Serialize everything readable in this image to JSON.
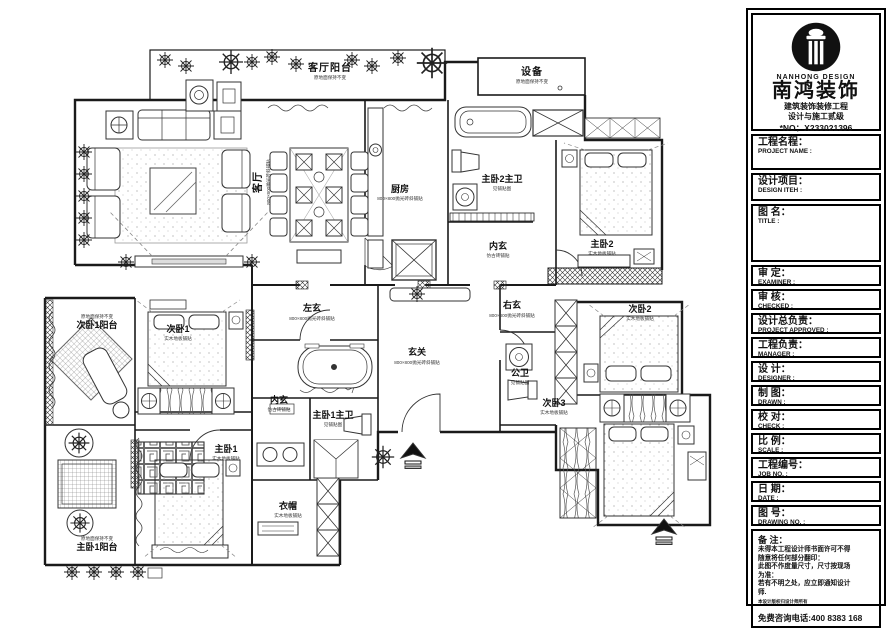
{
  "titleblock": {
    "brand": {
      "brand_en": "NANHONG DESIGN",
      "brand_cn": "南鸿装饰",
      "cert_line1": "建筑装饰装修工程",
      "cert_line2": "设计与施工贰级",
      "cert_no": "*NO：X233021396"
    },
    "fields": [
      {
        "cn": "工程名程：",
        "en": "PROJECT NAME :"
      },
      {
        "cn": "设计项目：",
        "en": "DESIGN ITEH :"
      },
      {
        "cn": "图 名：",
        "en": "TITLE :"
      },
      {
        "cn": "审  定：",
        "en": "EXAMINER :"
      },
      {
        "cn": "审  核：",
        "en": "CHECKED :"
      },
      {
        "cn": "设计总负责：",
        "en": "PROJECT APPROVED :"
      },
      {
        "cn": "工程负责：",
        "en": "MANAGER :"
      },
      {
        "cn": "设  计：",
        "en": "DESIGNER :"
      },
      {
        "cn": "制  图：",
        "en": "DRAWN :"
      },
      {
        "cn": "校  对：",
        "en": "CHECK :"
      },
      {
        "cn": "比  例：",
        "en": "SCALE :"
      },
      {
        "cn": "工程编号：",
        "en": "JOB NO. :"
      },
      {
        "cn": "日  期：",
        "en": "DATE :"
      },
      {
        "cn": "图  号：",
        "en": "DRAWING NO. :"
      }
    ],
    "remarks": {
      "label": "备 注：",
      "lines": [
        "未得本工程设计师书面许可不得",
        "随意将任何部分翻印：",
        "此图不作度量尺寸，尺寸按现场",
        "为准：",
        "若有不明之处，应立即通知设计",
        "师."
      ],
      "tiny": "本设计版权归设计师所有",
      "hotline": "免费咨询电话:400 8383 168"
    }
  },
  "plan": {
    "rooms": [
      {
        "name": "客厅阳台",
        "note": "原地面保持不变"
      },
      {
        "name": "设备",
        "note": "原地面保持不变"
      },
      {
        "name": "客厅",
        "note": "800×800抛光砖斜铺贴"
      },
      {
        "name": "厨房",
        "note": "800×800抛光砖斜铺贴"
      },
      {
        "name": "主卧2主卫",
        "note": "见铺贴图"
      },
      {
        "name": "内玄",
        "note": "仿古砖铺贴"
      },
      {
        "name": "主卧2",
        "note": "实木地板铺贴"
      },
      {
        "name": "左玄",
        "note": "800×800抛光砖斜铺贴"
      },
      {
        "name": "右玄",
        "note": "800×800抛光砖斜铺贴"
      },
      {
        "name": "玄关",
        "note": "800×800抛光砖斜铺贴"
      },
      {
        "name": "公卫",
        "note": "见铺贴图"
      },
      {
        "name": "次卧2",
        "note": "实木地板铺贴"
      },
      {
        "name": "次卧1阳台",
        "note": "原地面保持不变"
      },
      {
        "name": "次卧1",
        "note": "实木地板铺贴"
      },
      {
        "name": "内玄",
        "note": "仿古砖铺贴"
      },
      {
        "name": "主卧1主卫",
        "note": "见铺贴图"
      },
      {
        "name": "主卧1",
        "note": "实木地板铺贴"
      },
      {
        "name": "衣帽",
        "note": "实木地板铺贴"
      },
      {
        "name": "次卧3",
        "note": "实木地板铺贴"
      },
      {
        "name": "主卧1阳台",
        "note": "原地面保持不变"
      }
    ]
  }
}
